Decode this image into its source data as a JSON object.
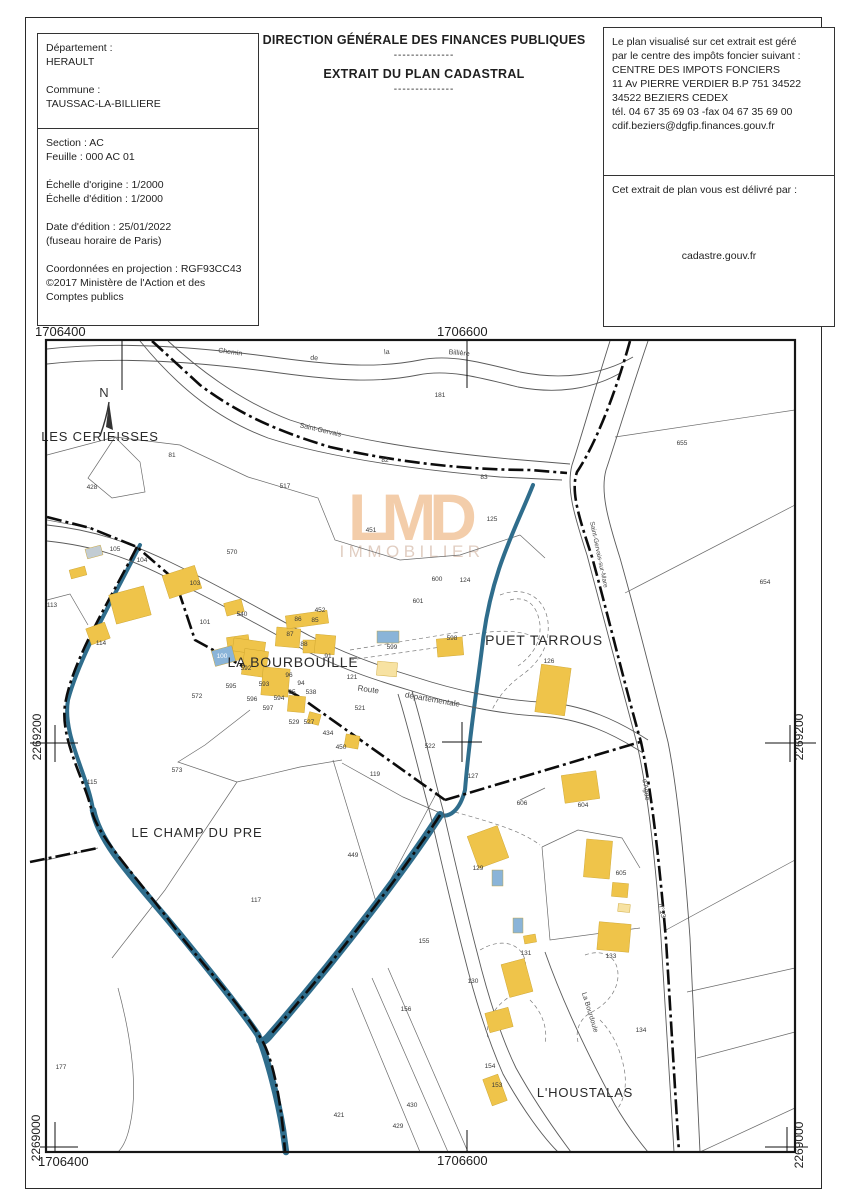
{
  "header": {
    "org_title": "DIRECTION GÉNÉRALE DES FINANCES PUBLIQUES",
    "dashes1": "--------------",
    "doc_title": "EXTRAIT DU PLAN CADASTRAL",
    "dashes2": "--------------",
    "info_left_top": {
      "lines": [
        "Département :",
        "HERAULT",
        "",
        "Commune :",
        "TAUSSAC-LA-BILLIERE"
      ]
    },
    "info_left_bottom": {
      "lines": [
        "Section : AC",
        "Feuille : 000 AC 01",
        "",
        "Échelle d'origine : 1/2000",
        "Échelle d'édition : 1/2000",
        "",
        "Date d'édition : 25/01/2022",
        "(fuseau horaire de Paris)",
        "",
        "Coordonnées en projection : RGF93CC43",
        "©2017 Ministère de l'Action et des",
        "Comptes publics"
      ]
    },
    "info_right_top": {
      "lines": [
        "Le plan visualisé sur cet extrait est géré",
        "par le centre des impôts foncier suivant :",
        "CENTRE DES IMPOTS FONCIERS",
        "11 Av PIERRE VERDIER B.P 751 34522",
        "34522 BEZIERS CEDEX",
        "tél. 04 67 35 69 03 -fax 04 67 35 69 00",
        "cdif.beziers@dgfip.finances.gouv.fr"
      ]
    },
    "info_right_bottom": {
      "intro": "Cet extrait de plan vous est délivré par :",
      "provider": "cadastre.gouv.fr"
    }
  },
  "map": {
    "north_label": "N",
    "watermark": {
      "word": "LMD",
      "subword": "IMMOBILIER",
      "color": "#f2c59c",
      "subcolor": "#dcc6b8"
    },
    "colors": {
      "building": "#efc44a",
      "building_light": "#f7e2a2",
      "building_blue": "#8ab4d8",
      "building_gray": "#c2ccd3",
      "water": "#2f6d8c"
    },
    "grid_labels": [
      {
        "text": "1706400",
        "x": 35,
        "y": 336,
        "rot": 0,
        "anchor": "start",
        "size": 13
      },
      {
        "text": "1706600",
        "x": 437,
        "y": 336,
        "rot": 0,
        "anchor": "start",
        "size": 13
      },
      {
        "text": "2269200",
        "x": 41,
        "y": 737,
        "rot": -90,
        "anchor": "middle",
        "size": 12
      },
      {
        "text": "2269200",
        "x": 803,
        "y": 737,
        "rot": -90,
        "anchor": "middle",
        "size": 12
      },
      {
        "text": "2269000",
        "x": 40,
        "y": 1138,
        "rot": -90,
        "anchor": "middle",
        "size": 12
      },
      {
        "text": "2269000",
        "x": 803,
        "y": 1145,
        "rot": -90,
        "anchor": "middle",
        "size": 12
      },
      {
        "text": "1706400",
        "x": 38,
        "y": 1166,
        "rot": 0,
        "anchor": "start",
        "size": 13
      },
      {
        "text": "1706600",
        "x": 437,
        "y": 1165,
        "rot": 0,
        "anchor": "start",
        "size": 13
      }
    ],
    "place_labels": [
      {
        "text": "LES CERIEISSES",
        "x": 100,
        "y": 441,
        "size": 13
      },
      {
        "text": "LA BOURBOUILLE",
        "x": 293,
        "y": 667,
        "size": 14
      },
      {
        "text": "PUET TARROUS",
        "x": 544,
        "y": 645,
        "size": 14
      },
      {
        "text": "LE CHAMP DU PRE",
        "x": 197,
        "y": 837,
        "size": 13
      },
      {
        "text": "L'HOUSTALAS",
        "x": 585,
        "y": 1097,
        "size": 13
      }
    ],
    "road_labels": [
      {
        "text": "Chemin",
        "x": 230,
        "y": 354,
        "rot": 8,
        "size": 7
      },
      {
        "text": "de",
        "x": 314,
        "y": 360,
        "rot": 5,
        "size": 7
      },
      {
        "text": "la",
        "x": 387,
        "y": 354,
        "rot": -5,
        "size": 7
      },
      {
        "text": "Billière",
        "x": 459,
        "y": 355,
        "rot": 5,
        "size": 7
      },
      {
        "text": "Saint-Gervais",
        "x": 320,
        "y": 432,
        "rot": 13,
        "size": 7
      },
      {
        "text": "Saint-Gervais-sur-Mare",
        "x": 597,
        "y": 555,
        "rot": 78,
        "size": 6.5
      },
      {
        "text": "Route",
        "x": 368,
        "y": 692,
        "rot": 8,
        "size": 8
      },
      {
        "text": "départementale",
        "x": 432,
        "y": 702,
        "rot": 10,
        "size": 8
      },
      {
        "text": "d'Agde",
        "x": 644,
        "y": 790,
        "rot": 82,
        "size": 7
      },
      {
        "text": "n°13",
        "x": 660,
        "y": 911,
        "rot": 80,
        "size": 7
      },
      {
        "text": "La Bourdoule",
        "x": 588,
        "y": 1013,
        "rot": 73,
        "size": 7
      }
    ],
    "parcel_numbers": [
      {
        "n": "81",
        "x": 172,
        "y": 457
      },
      {
        "n": "428",
        "x": 92,
        "y": 489
      },
      {
        "n": "517",
        "x": 285,
        "y": 488
      },
      {
        "n": "82",
        "x": 385,
        "y": 462
      },
      {
        "n": "83",
        "x": 484,
        "y": 479
      },
      {
        "n": "181",
        "x": 440,
        "y": 397
      },
      {
        "n": "125",
        "x": 492,
        "y": 521
      },
      {
        "n": "451",
        "x": 371,
        "y": 532
      },
      {
        "n": "655",
        "x": 682,
        "y": 445
      },
      {
        "n": "654",
        "x": 765,
        "y": 584
      },
      {
        "n": "570",
        "x": 232,
        "y": 554
      },
      {
        "n": "105",
        "x": 115,
        "y": 551
      },
      {
        "n": "104",
        "x": 142,
        "y": 562
      },
      {
        "n": "600",
        "x": 437,
        "y": 581
      },
      {
        "n": "601",
        "x": 418,
        "y": 603
      },
      {
        "n": "124",
        "x": 465,
        "y": 582
      },
      {
        "n": "452",
        "x": 320,
        "y": 612
      },
      {
        "n": "86",
        "x": 298,
        "y": 621
      },
      {
        "n": "85",
        "x": 315,
        "y": 622
      },
      {
        "n": "101",
        "x": 205,
        "y": 624
      },
      {
        "n": "540",
        "x": 242,
        "y": 616
      },
      {
        "n": "103",
        "x": 195,
        "y": 585
      },
      {
        "n": "87",
        "x": 290,
        "y": 636
      },
      {
        "n": "88",
        "x": 304,
        "y": 646
      },
      {
        "n": "91",
        "x": 328,
        "y": 658
      },
      {
        "n": "598",
        "x": 452,
        "y": 640
      },
      {
        "n": "599",
        "x": 392,
        "y": 649
      },
      {
        "n": "100",
        "x": 222,
        "y": 658,
        "c": "w"
      },
      {
        "n": "592",
        "x": 246,
        "y": 670
      },
      {
        "n": "96",
        "x": 289,
        "y": 677
      },
      {
        "n": "94",
        "x": 301,
        "y": 685
      },
      {
        "n": "95",
        "x": 292,
        "y": 694
      },
      {
        "n": "595",
        "x": 231,
        "y": 688
      },
      {
        "n": "593",
        "x": 264,
        "y": 686
      },
      {
        "n": "572",
        "x": 197,
        "y": 698
      },
      {
        "n": "596",
        "x": 252,
        "y": 701
      },
      {
        "n": "594",
        "x": 279,
        "y": 700
      },
      {
        "n": "597",
        "x": 268,
        "y": 710
      },
      {
        "n": "538",
        "x": 311,
        "y": 694
      },
      {
        "n": "121",
        "x": 352,
        "y": 679
      },
      {
        "n": "521",
        "x": 360,
        "y": 710
      },
      {
        "n": "529",
        "x": 294,
        "y": 724
      },
      {
        "n": "527",
        "x": 309,
        "y": 724
      },
      {
        "n": "434",
        "x": 328,
        "y": 735
      },
      {
        "n": "450",
        "x": 341,
        "y": 749
      },
      {
        "n": "522",
        "x": 430,
        "y": 748
      },
      {
        "n": "119",
        "x": 375,
        "y": 776
      },
      {
        "n": "127",
        "x": 473,
        "y": 778
      },
      {
        "n": "113",
        "x": 52,
        "y": 607
      },
      {
        "n": "114",
        "x": 101,
        "y": 645
      },
      {
        "n": "115",
        "x": 92,
        "y": 784
      },
      {
        "n": "573",
        "x": 177,
        "y": 772
      },
      {
        "n": "449",
        "x": 353,
        "y": 857
      },
      {
        "n": "117",
        "x": 256,
        "y": 902
      },
      {
        "n": "155",
        "x": 424,
        "y": 943
      },
      {
        "n": "156",
        "x": 406,
        "y": 1011
      },
      {
        "n": "177",
        "x": 61,
        "y": 1069
      },
      {
        "n": "421",
        "x": 339,
        "y": 1117
      },
      {
        "n": "429",
        "x": 398,
        "y": 1128
      },
      {
        "n": "430",
        "x": 412,
        "y": 1107
      },
      {
        "n": "604",
        "x": 583,
        "y": 807
      },
      {
        "n": "605",
        "x": 621,
        "y": 875
      },
      {
        "n": "606",
        "x": 522,
        "y": 805
      },
      {
        "n": "129",
        "x": 478,
        "y": 870
      },
      {
        "n": "130",
        "x": 473,
        "y": 983
      },
      {
        "n": "131",
        "x": 526,
        "y": 955
      },
      {
        "n": "133",
        "x": 611,
        "y": 958
      },
      {
        "n": "134",
        "x": 641,
        "y": 1032
      },
      {
        "n": "154",
        "x": 490,
        "y": 1068
      },
      {
        "n": "153",
        "x": 497,
        "y": 1087
      },
      {
        "n": "126",
        "x": 549,
        "y": 663
      }
    ],
    "buildings": [
      [
        165,
        570,
        34,
        24,
        -18,
        "y"
      ],
      [
        112,
        590,
        36,
        30,
        -15,
        "y"
      ],
      [
        88,
        625,
        20,
        17,
        -20,
        "y"
      ],
      [
        70,
        568,
        16,
        9,
        -15,
        "y"
      ],
      [
        86,
        547,
        16,
        10,
        -15,
        "g"
      ],
      [
        225,
        601,
        18,
        13,
        -15,
        "y"
      ],
      [
        228,
        636,
        22,
        24,
        -8,
        "y"
      ],
      [
        233,
        640,
        32,
        13,
        8,
        "y"
      ],
      [
        243,
        650,
        24,
        26,
        8,
        "y"
      ],
      [
        276,
        628,
        24,
        19,
        5,
        "y"
      ],
      [
        286,
        613,
        42,
        13,
        -8,
        "y"
      ],
      [
        303,
        640,
        16,
        13,
        0,
        "y"
      ],
      [
        315,
        635,
        20,
        19,
        5,
        "y"
      ],
      [
        262,
        668,
        27,
        28,
        5,
        "y"
      ],
      [
        288,
        696,
        17,
        16,
        5,
        "y"
      ],
      [
        308,
        713,
        12,
        11,
        15,
        "y"
      ],
      [
        345,
        735,
        14,
        13,
        10,
        "y"
      ],
      [
        437,
        638,
        26,
        18,
        -5,
        "y"
      ],
      [
        538,
        666,
        30,
        48,
        8,
        "y"
      ],
      [
        377,
        662,
        20,
        14,
        5,
        "l"
      ],
      [
        618,
        904,
        12,
        8,
        5,
        "l"
      ],
      [
        213,
        648,
        21,
        16,
        -15,
        "b"
      ],
      [
        377,
        631,
        22,
        12,
        0,
        "b"
      ],
      [
        492,
        870,
        11,
        16,
        0,
        "b"
      ],
      [
        513,
        918,
        10,
        15,
        0,
        "b"
      ],
      [
        563,
        773,
        35,
        28,
        -8,
        "y"
      ],
      [
        472,
        830,
        32,
        34,
        -20,
        "y"
      ],
      [
        585,
        840,
        26,
        38,
        5,
        "y"
      ],
      [
        612,
        883,
        16,
        14,
        5,
        "y"
      ],
      [
        598,
        923,
        32,
        28,
        5,
        "y"
      ],
      [
        524,
        935,
        12,
        8,
        -10,
        "y"
      ],
      [
        505,
        961,
        24,
        34,
        -15,
        "y"
      ],
      [
        487,
        1010,
        24,
        20,
        -15,
        "y"
      ],
      [
        487,
        1076,
        16,
        28,
        -20,
        "y"
      ]
    ]
  }
}
